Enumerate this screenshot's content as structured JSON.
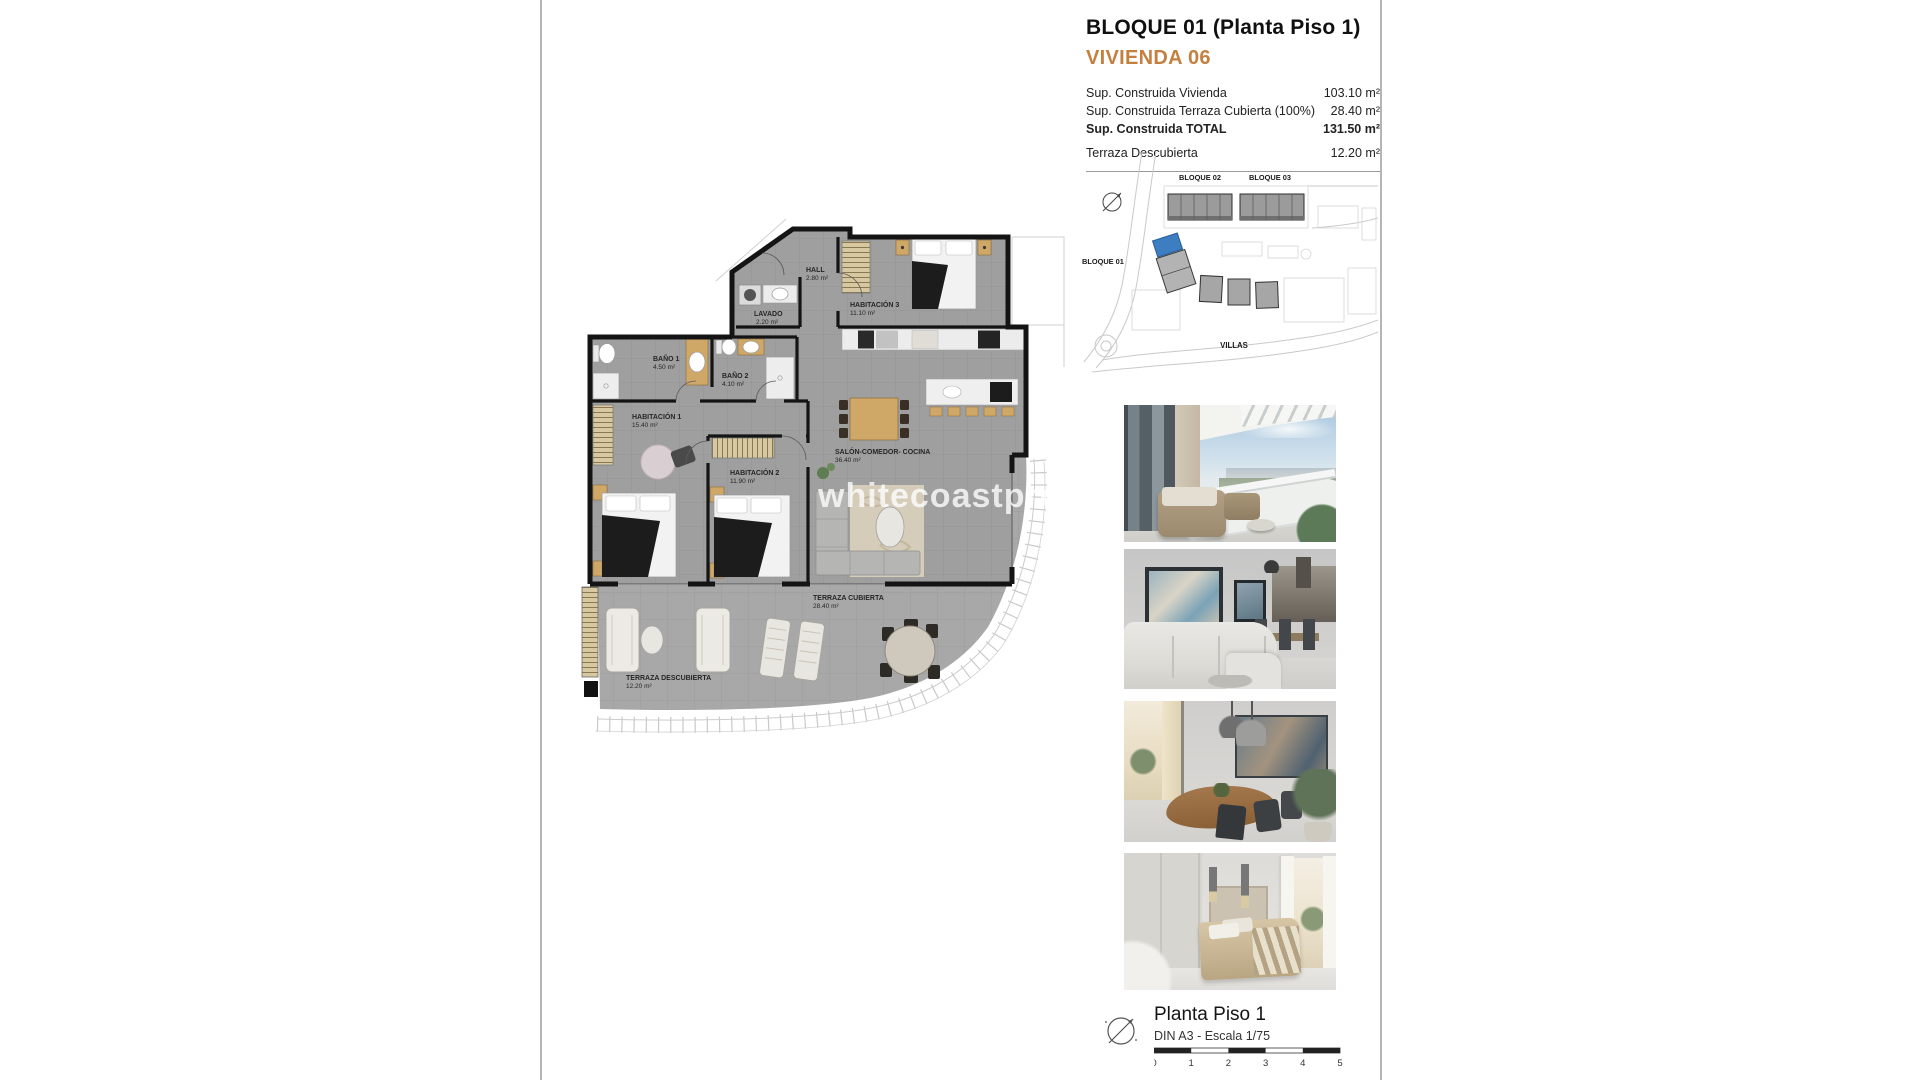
{
  "page": {
    "rule_color": "#b5b5b5"
  },
  "header": {
    "title": "BLOQUE 01  (Planta Piso 1)",
    "subtitle": "VIVIENDA 06",
    "accent_color": "#c5803f",
    "area_rows": [
      {
        "label": "Sup. Construida Vivienda",
        "value": "103.10 m²"
      },
      {
        "label": "Sup. Construida Terraza Cubierta (100%)",
        "value": "28.40 m²"
      },
      {
        "label": "Sup. Construida TOTAL",
        "value": "131.50 m²"
      },
      {
        "label": "Terraza Descubierta",
        "value": "12.20 m²"
      }
    ]
  },
  "site_plan": {
    "labels": {
      "bloque01": "BLOQUE 01",
      "bloque02": "BLOQUE 02",
      "bloque03": "BLOQUE 03",
      "villas": "VILLAS"
    },
    "highlight_color": "#3d7ec2"
  },
  "floorplan": {
    "watermark": "whitecoastproperties",
    "rooms": {
      "hall": {
        "name": "HALL",
        "area": "2.80 m²"
      },
      "lavado": {
        "name": "LAVADO",
        "area": "2.20 m²"
      },
      "habitacion3": {
        "name": "HABITACIÓN 3",
        "area": "11.10 m²"
      },
      "bano1": {
        "name": "BAÑO 1",
        "area": "4.50 m²"
      },
      "bano2": {
        "name": "BAÑO 2",
        "area": "4.10 m²"
      },
      "habitacion1": {
        "name": "HABITACIÓN 1",
        "area": "15.40 m²"
      },
      "habitacion2": {
        "name": "HABITACIÓN 2",
        "area": "11.90 m²"
      },
      "salon": {
        "name": "SALÓN-COMEDOR- COCINA",
        "area": "36.40 m²"
      },
      "terraza_cubierta": {
        "name": "TERRAZA CUBIERTA",
        "area": "28.40 m²"
      },
      "terraza_descubierta": {
        "name": "TERRAZA DESCUBIERTA",
        "area": "12.20 m²"
      }
    }
  },
  "footer": {
    "title": "Planta Piso 1",
    "scale_note": "DIN A3 - Escala 1/75",
    "scale_ticks": [
      "0",
      "1",
      "2",
      "3",
      "4",
      "5"
    ]
  }
}
